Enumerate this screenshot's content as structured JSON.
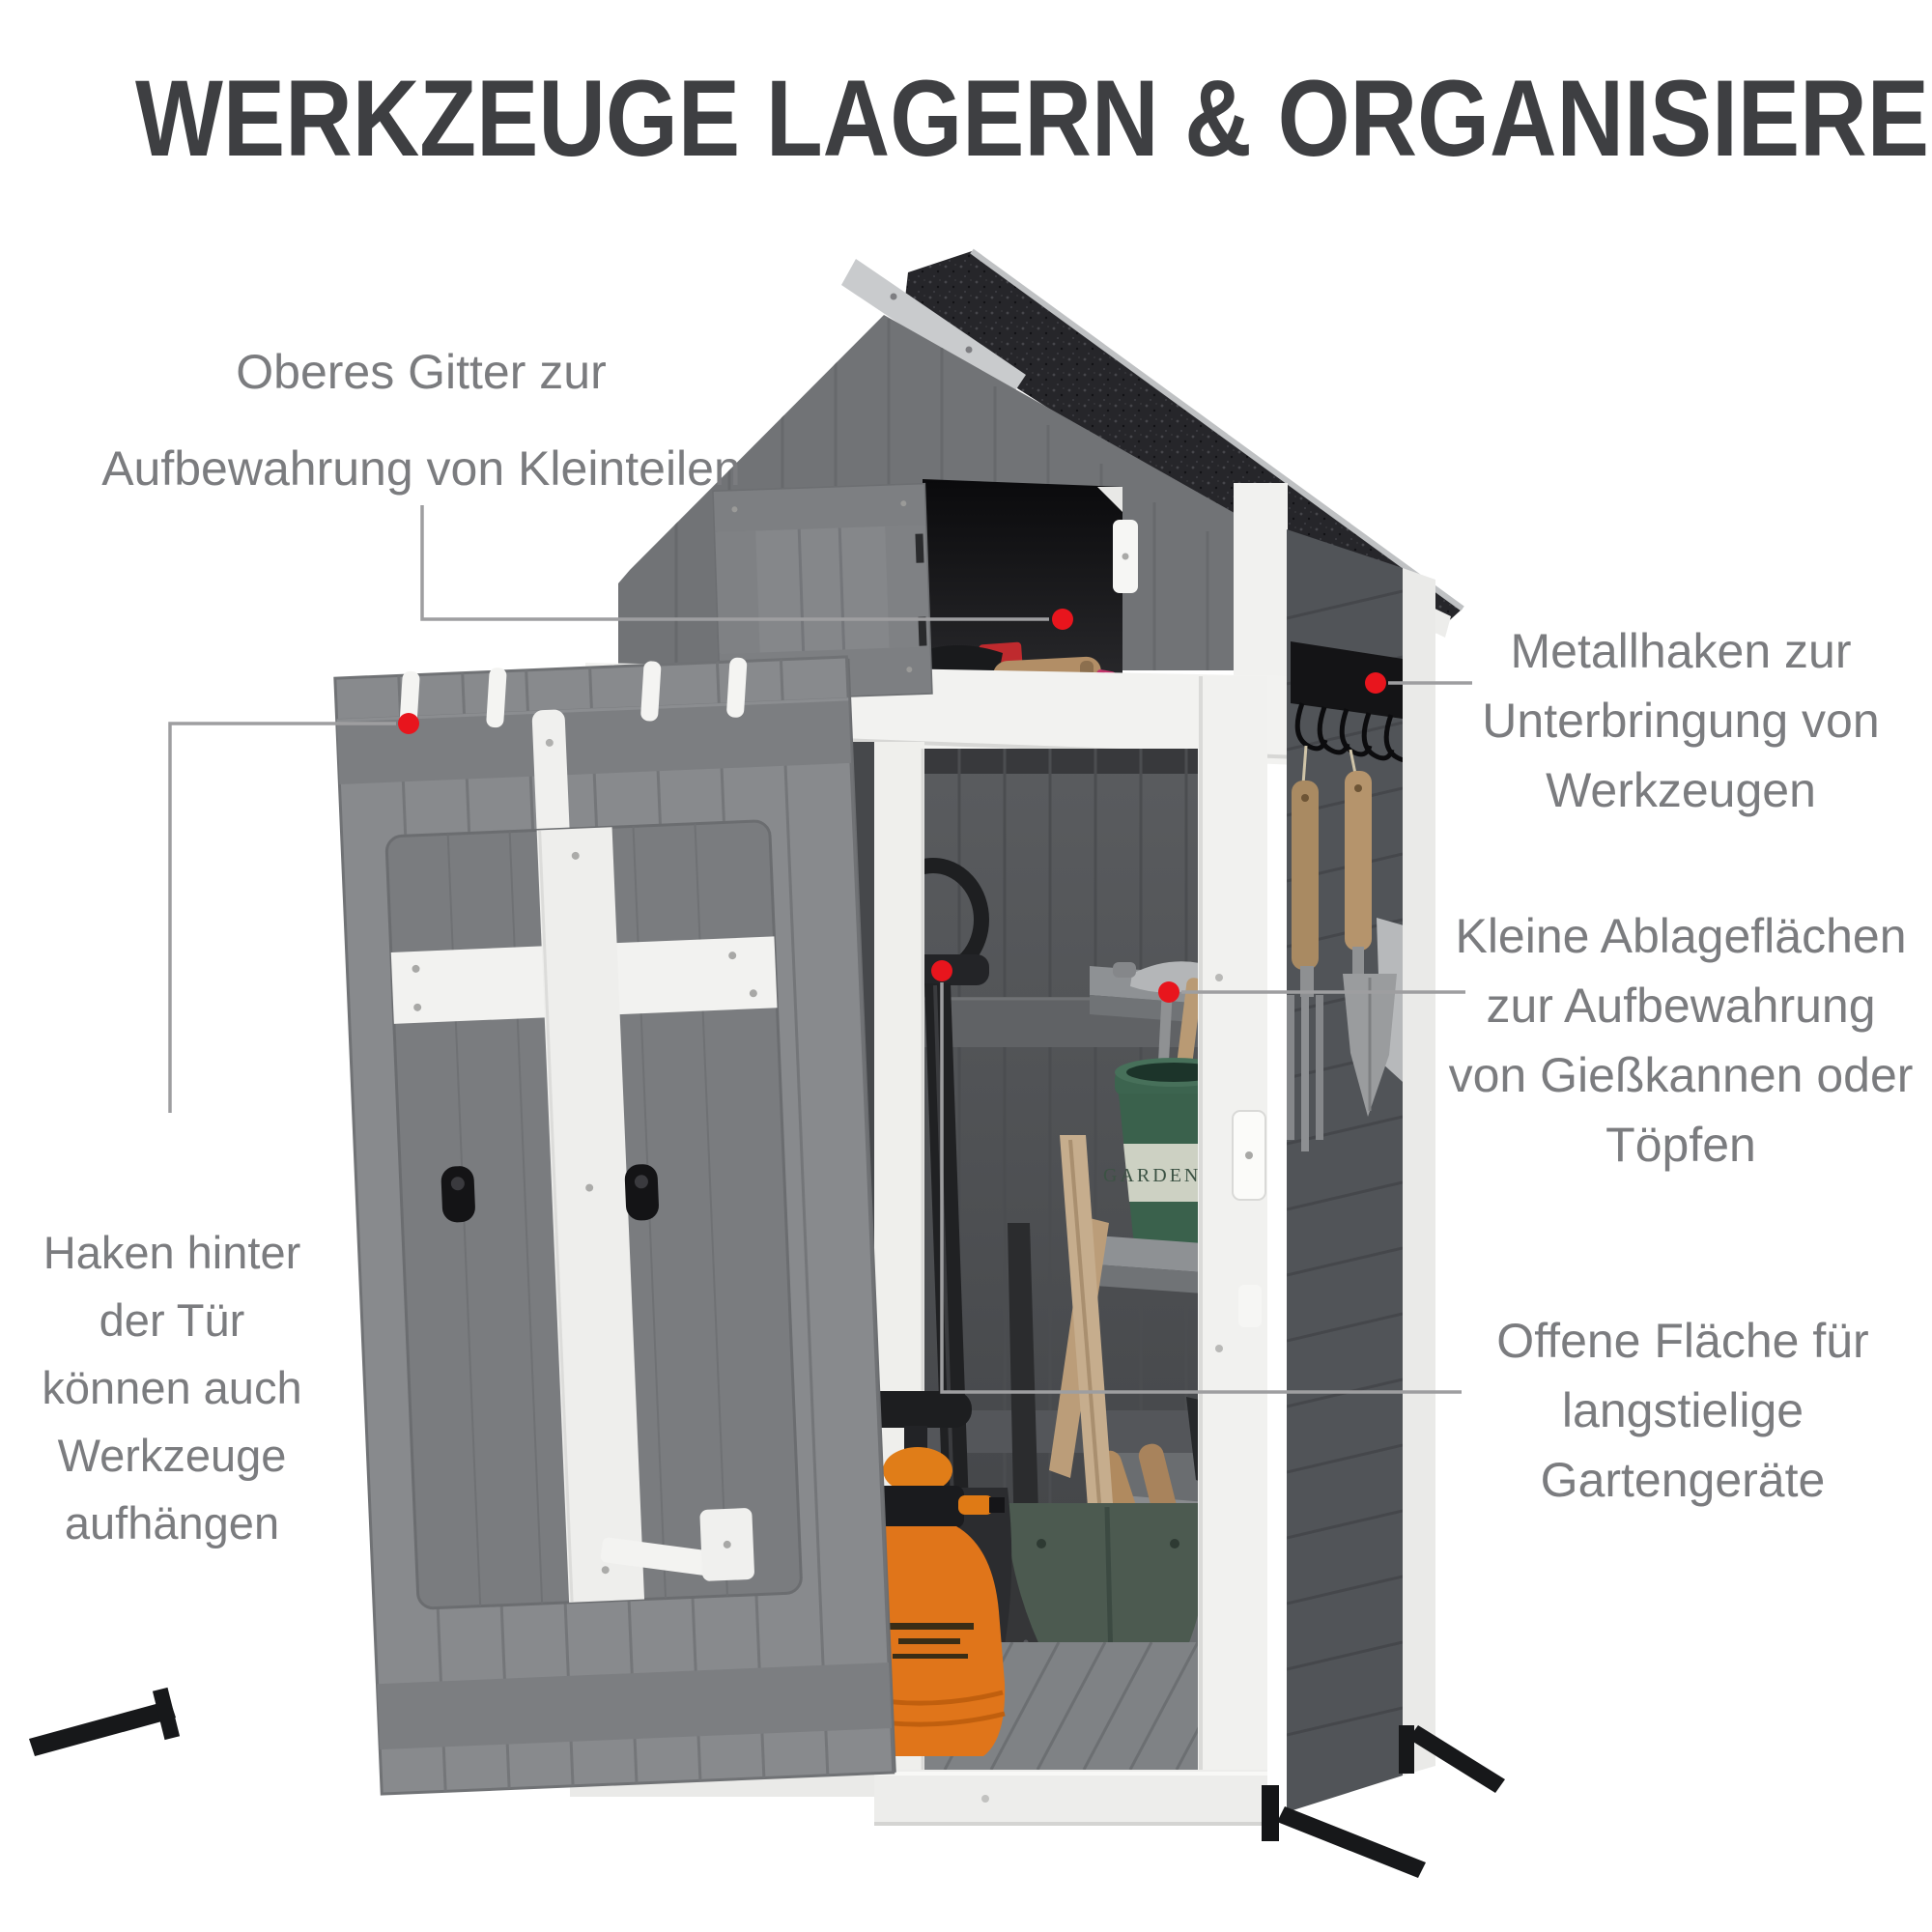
{
  "title": "WERKZEUGE LAGERN & ORGANISIEREN",
  "annotations": {
    "oberes_gitter": {
      "lines": [
        "Oberes Gitter zur",
        "Aufbewahrung von Kleinteilen"
      ]
    },
    "metallhaken": {
      "lines": [
        "Metallhaken zur",
        "Unterbringung von",
        "Werkzeugen"
      ]
    },
    "kleine_ablage": {
      "lines": [
        "Kleine Ablageflächen",
        "zur Aufbewahrung",
        "von Gießkannen oder",
        "Töpfen"
      ]
    },
    "haken_tuer": {
      "lines": [
        "Haken hinter",
        "der Tür",
        "können auch",
        "Werkzeuge",
        "aufhängen"
      ]
    },
    "offene_flaeche": {
      "lines": [
        "Offene Fläche für",
        "langstielige",
        "Gartengeräte"
      ]
    }
  },
  "shed": {
    "pot_label": "GARDENING"
  },
  "palette": {
    "title_text": "#3e3f42",
    "annotation_text": "#7b7c7f",
    "callout_line": "#9e9ea0",
    "callout_dot": "#e8151d",
    "shed_white": "#f1f1ef",
    "door_gray": "#87898c",
    "side_wall_gray": "#515458",
    "roof_asphalt": "#26262a",
    "sprayer_orange": "#e0751a",
    "pot_green": "#3a614c"
  }
}
